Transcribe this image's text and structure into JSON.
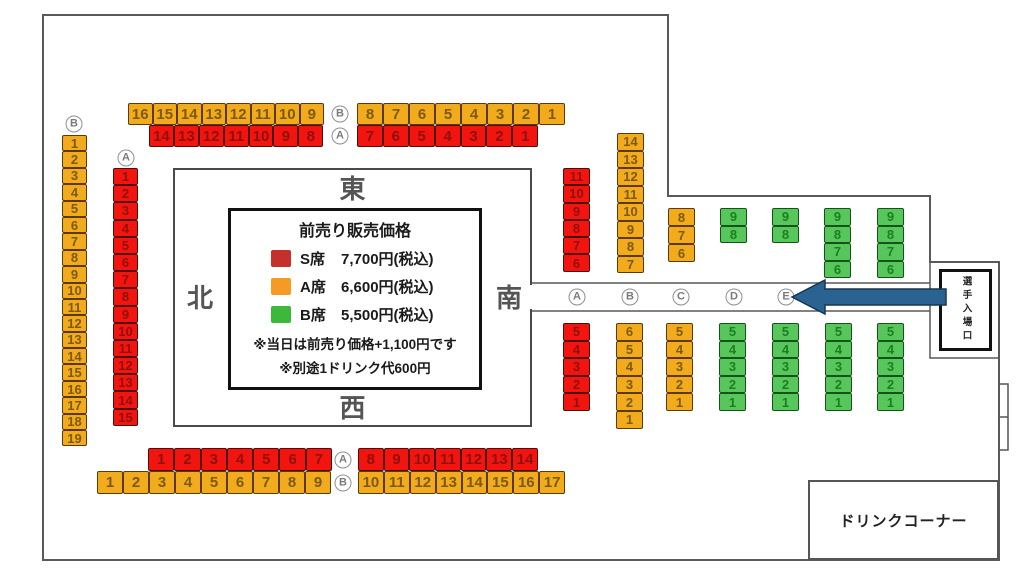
{
  "colors": {
    "arrow_fill": "#2a6391",
    "arrow_stroke": "#16374f",
    "seat_fill": {
      "S": "#f2150f",
      "A": "#f2ab1c",
      "B": "#58c75b"
    },
    "seat_num": {
      "S": "#8f100c",
      "A": "#7b5a10",
      "B": "#1d7d22"
    },
    "seat_border": {
      "S": "#4f0d05",
      "A": "#5b3a08",
      "B": "#14541a"
    }
  },
  "compass": {
    "top": "東",
    "left": "北",
    "right": "南",
    "bottom": "西"
  },
  "price_box": {
    "title": "前売り販売価格",
    "rows": [
      {
        "seat_class": "S席",
        "price": "7,700円(税込)",
        "swatch": "#c5302b"
      },
      {
        "seat_class": "A席",
        "price": "6,600円(税込)",
        "swatch": "#f59a23"
      },
      {
        "seat_class": "B席",
        "price": "5,500円(税込)",
        "swatch": "#3cb93c"
      }
    ],
    "notes": [
      "※当日は前売り価格+1,100円です",
      "※別途1ドリンク代600円"
    ]
  },
  "entrance_sign": "選手入場口",
  "drink_corner_label": "ドリンクコーナー",
  "seat_groups": [
    {
      "id": "top-row-a-left",
      "cls": "A",
      "dir": "h",
      "x": 128,
      "y": 103,
      "cw": 24.5,
      "ch": 22,
      "nums": [
        16,
        15,
        14,
        13,
        12,
        11,
        10,
        9
      ]
    },
    {
      "id": "top-row-s-left",
      "cls": "S",
      "dir": "h",
      "x": 149,
      "y": 125,
      "cw": 24.9,
      "ch": 22,
      "nums": [
        14,
        13,
        12,
        11,
        10,
        9,
        8
      ]
    },
    {
      "id": "top-row-a-right",
      "cls": "A",
      "dir": "h",
      "x": 357,
      "y": 103,
      "cw": 26,
      "ch": 22,
      "nums": [
        8,
        7,
        6,
        5,
        4,
        3,
        2,
        1
      ]
    },
    {
      "id": "top-row-s-right",
      "cls": "S",
      "dir": "h",
      "x": 357,
      "y": 125,
      "cw": 25.9,
      "ch": 22,
      "nums": [
        7,
        6,
        5,
        4,
        3,
        2,
        1
      ]
    },
    {
      "id": "left-col-a",
      "cls": "A",
      "dir": "v",
      "x": 62,
      "y": 135,
      "cw": 25,
      "ch": 16.4,
      "nums": [
        1,
        2,
        3,
        4,
        5,
        6,
        7,
        8,
        9,
        10,
        11,
        12,
        13,
        14,
        15,
        16,
        17,
        18,
        19
      ]
    },
    {
      "id": "left-col-s",
      "cls": "S",
      "dir": "v",
      "x": 113,
      "y": 168,
      "cw": 25,
      "ch": 17.2,
      "nums": [
        1,
        2,
        3,
        4,
        5,
        6,
        7,
        8,
        9,
        10,
        11,
        12,
        13,
        14,
        15
      ]
    },
    {
      "id": "mid-col-a",
      "cls": "S",
      "dir": "v",
      "x": 563,
      "y": 168,
      "cw": 27,
      "ch": 17.3,
      "nums": [
        11,
        10,
        9,
        8,
        7,
        6
      ]
    },
    {
      "id": "mid-col-b",
      "cls": "A",
      "dir": "v",
      "x": 617,
      "y": 133,
      "cw": 27,
      "ch": 17.5,
      "nums": [
        14,
        13,
        12,
        11,
        10,
        9,
        8,
        7
      ]
    },
    {
      "id": "mid-col-c",
      "cls": "A",
      "dir": "v",
      "x": 668,
      "y": 208,
      "cw": 27,
      "ch": 18,
      "nums": [
        8,
        7,
        6
      ]
    },
    {
      "id": "mid-col-d",
      "cls": "B",
      "dir": "v",
      "x": 720,
      "y": 208,
      "cw": 27,
      "ch": 17.5,
      "nums": [
        9,
        8
      ]
    },
    {
      "id": "mid-col-e",
      "cls": "B",
      "dir": "v",
      "x": 772,
      "y": 208,
      "cw": 27,
      "ch": 17.5,
      "nums": [
        9,
        8
      ]
    },
    {
      "id": "mid-col-f",
      "cls": "B",
      "dir": "v",
      "x": 824,
      "y": 208,
      "cw": 27,
      "ch": 17.5,
      "nums": [
        9,
        8,
        7,
        6
      ]
    },
    {
      "id": "mid-col-g",
      "cls": "B",
      "dir": "v",
      "x": 877,
      "y": 208,
      "cw": 27,
      "ch": 17.5,
      "nums": [
        9,
        8,
        7,
        6
      ]
    },
    {
      "id": "low-col-a",
      "cls": "S",
      "dir": "v",
      "x": 563,
      "y": 323,
      "cw": 27,
      "ch": 17.6,
      "nums": [
        5,
        4,
        3,
        2,
        1
      ]
    },
    {
      "id": "low-col-b",
      "cls": "A",
      "dir": "v",
      "x": 616,
      "y": 323,
      "cw": 27,
      "ch": 17.6,
      "nums": [
        6,
        5,
        4,
        3,
        2,
        1
      ]
    },
    {
      "id": "low-col-c",
      "cls": "A",
      "dir": "v",
      "x": 666,
      "y": 323,
      "cw": 27,
      "ch": 17.6,
      "nums": [
        5,
        4,
        3,
        2,
        1
      ]
    },
    {
      "id": "low-col-d",
      "cls": "B",
      "dir": "v",
      "x": 719,
      "y": 323,
      "cw": 27,
      "ch": 17.6,
      "nums": [
        5,
        4,
        3,
        2,
        1
      ]
    },
    {
      "id": "low-col-e",
      "cls": "B",
      "dir": "v",
      "x": 772,
      "y": 323,
      "cw": 27,
      "ch": 17.6,
      "nums": [
        5,
        4,
        3,
        2,
        1
      ]
    },
    {
      "id": "low-col-f",
      "cls": "B",
      "dir": "v",
      "x": 825,
      "y": 323,
      "cw": 27,
      "ch": 17.6,
      "nums": [
        5,
        4,
        3,
        2,
        1
      ]
    },
    {
      "id": "low-col-g",
      "cls": "B",
      "dir": "v",
      "x": 877,
      "y": 323,
      "cw": 27,
      "ch": 17.6,
      "nums": [
        5,
        4,
        3,
        2,
        1
      ]
    },
    {
      "id": "bottom-row-s-left",
      "cls": "S",
      "dir": "h",
      "x": 148,
      "y": 448,
      "cw": 26.3,
      "ch": 23,
      "nums": [
        1,
        2,
        3,
        4,
        5,
        6,
        7
      ]
    },
    {
      "id": "bottom-row-s-right",
      "cls": "S",
      "dir": "h",
      "x": 358,
      "y": 448,
      "cw": 25.7,
      "ch": 23,
      "nums": [
        8,
        9,
        10,
        11,
        12,
        13,
        14
      ]
    },
    {
      "id": "bottom-row-a-left",
      "cls": "A",
      "dir": "h",
      "x": 97,
      "y": 471,
      "cw": 26,
      "ch": 23,
      "nums": [
        1,
        2,
        3,
        4,
        5,
        6,
        7,
        8,
        9
      ]
    },
    {
      "id": "bottom-row-a-right",
      "cls": "A",
      "dir": "h",
      "x": 358,
      "y": 471,
      "cw": 25.9,
      "ch": 23,
      "nums": [
        10,
        11,
        12,
        13,
        14,
        15,
        16,
        17
      ]
    }
  ],
  "row_labels": [
    {
      "letter": "B",
      "x": 340,
      "y": 114
    },
    {
      "letter": "A",
      "x": 340,
      "y": 136
    },
    {
      "letter": "B",
      "x": 74,
      "y": 124
    },
    {
      "letter": "A",
      "x": 126,
      "y": 158
    },
    {
      "letter": "A",
      "x": 577,
      "y": 297
    },
    {
      "letter": "B",
      "x": 630,
      "y": 297
    },
    {
      "letter": "C",
      "x": 681,
      "y": 297
    },
    {
      "letter": "D",
      "x": 734,
      "y": 297
    },
    {
      "letter": "E",
      "x": 786,
      "y": 297
    },
    {
      "letter": "A",
      "x": 343,
      "y": 460
    },
    {
      "letter": "B",
      "x": 343,
      "y": 483
    }
  ]
}
